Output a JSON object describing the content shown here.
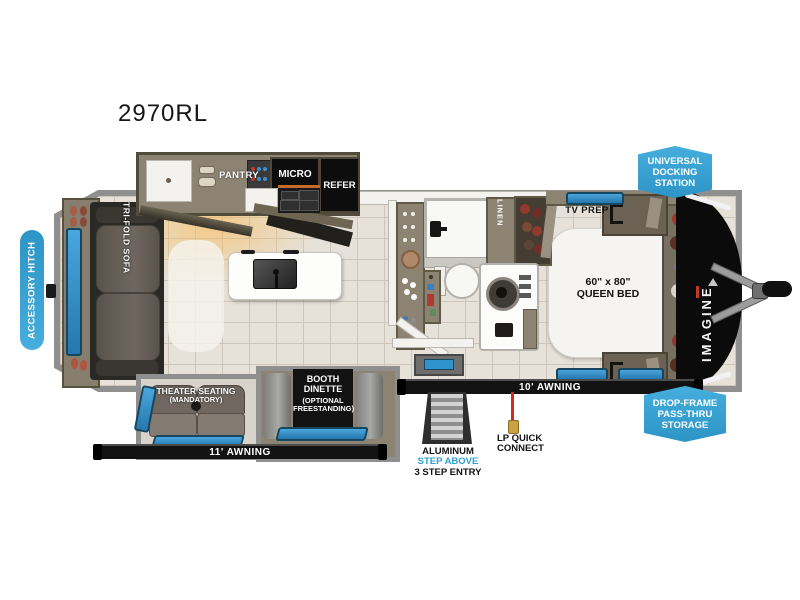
{
  "title": "2970RL",
  "badges": {
    "accessory_hitch": "ACCESSORY HITCH",
    "universal_docking": {
      "l1": "UNIVERSAL",
      "l2": "DOCKING",
      "l3": "STATION"
    },
    "drop_frame": {
      "l1": "DROP-FRAME",
      "l2": "PASS-THRU",
      "l3": "STORAGE"
    }
  },
  "kitchen": {
    "pantry": "PANTRY",
    "micro": "MICRO",
    "refer": "REFER"
  },
  "living": {
    "sofa": "TRI-FOLD SOFA",
    "theater": {
      "l1": "THEATER SEATING",
      "l2": "(MANDATORY)"
    },
    "booth": {
      "l1": "BOOTH",
      "l2": "DINETTE",
      "l3": "(OPTIONAL",
      "l4": "FREESTANDING)"
    }
  },
  "bath": {
    "linen": "LINEN"
  },
  "bedroom": {
    "tv_prep": "TV PREP",
    "bed_l1": "60\" x 80\"",
    "bed_l2": "QUEEN BED"
  },
  "brand": {
    "nose": "IMAGINE"
  },
  "exterior": {
    "awning_11": "11' AWNING",
    "awning_10": "10' AWNING",
    "entry": {
      "l1": "ALUMINUM",
      "l2": "STEP ABOVE",
      "l3": "3 STEP ENTRY"
    },
    "lp": {
      "l1": "LP QUICK",
      "l2": "CONNECT"
    }
  },
  "colors": {
    "badge_blue": "#38a5d8",
    "window_blue": "#2f93cc",
    "blue_text": "#2e9fd0",
    "lp_red": "#cf2b1e",
    "body_taupe": "#8c8372",
    "floor_tile": "#e6e1d9"
  }
}
